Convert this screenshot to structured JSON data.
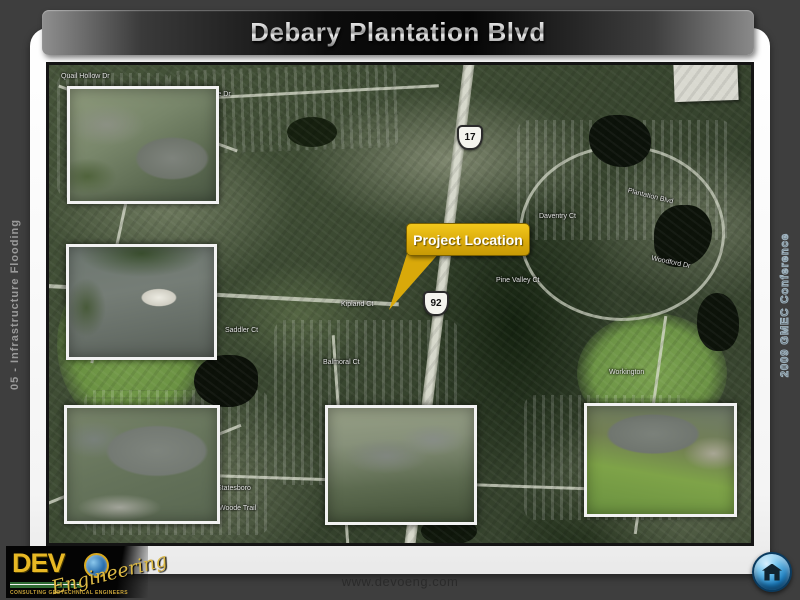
{
  "slide": {
    "title": "Debary Plantation Blvd",
    "left_tab": "05 - Infrastructure Flooding",
    "right_tab": "2009 GMEC Conference",
    "footer_url": "www.devoeng.com"
  },
  "logo": {
    "brand": "DEV",
    "script": "Engineering",
    "tagline": "CONSULTING  GEOTECHNICAL  ENGINEERS"
  },
  "colors": {
    "callout_yellow": "#d9a90a",
    "banner_black": "#0c0c0c",
    "home_button_blue": "#2f8fd0",
    "logo_gold": "#e8b824",
    "slide_background": "#3e3e3e"
  },
  "icons": {
    "home": "house"
  },
  "map": {
    "callout_label": "Project Location",
    "shields": [
      {
        "route": "17"
      },
      {
        "route": "92"
      }
    ],
    "street_labels": [
      {
        "text": "Quail Hollow Dr"
      },
      {
        "text": "Kingslake Dr"
      },
      {
        "text": "Plantation Blvd"
      },
      {
        "text": "Daventry Ct"
      },
      {
        "text": "Pine Valley Ct"
      },
      {
        "text": "Woodford Dr"
      },
      {
        "text": "Kipland Ct"
      },
      {
        "text": "Saddler Ct"
      },
      {
        "text": "Balmoral Ct"
      },
      {
        "text": "Statesboro"
      },
      {
        "text": "Woode Trail"
      },
      {
        "text": "Workington"
      }
    ]
  }
}
